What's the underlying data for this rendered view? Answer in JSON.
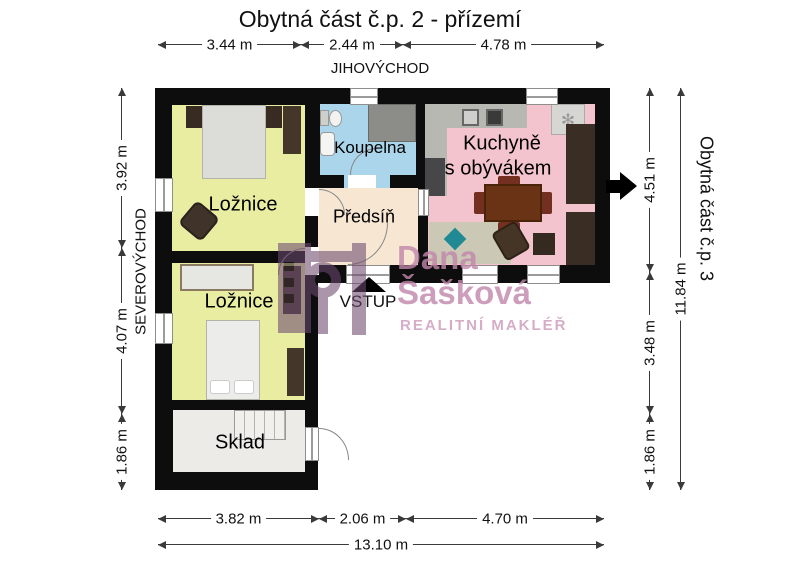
{
  "title": "Obytná část č.p. 2 - přízemí",
  "directions": {
    "southeast": "JIHOVÝCHOD",
    "northeast": "SEVEROVÝCHOD",
    "neighbor": "Obytná část č.p. 3"
  },
  "rooms": {
    "bedroom1": "Ložnice",
    "bedroom2": "Ložnice",
    "bathroom": "Koupelna",
    "hallway": "Předsíň",
    "kitchen_line1": "Kuchyně",
    "kitchen_line2": "s obývákem",
    "storage": "Sklad"
  },
  "entrance": {
    "label": "VSTUP"
  },
  "dimensions": {
    "top": [
      "3.44 m",
      "2.44 m",
      "4.78 m"
    ],
    "bottom": [
      "3.82 m",
      "2.06 m",
      "4.70 m"
    ],
    "bottom_total": "13.10 m",
    "left": [
      "3.92 m",
      "4.07 m",
      "1.86 m"
    ],
    "right": [
      "4.51 m",
      "3.48 m",
      "1.86 m"
    ],
    "right_total": "11.84 m"
  },
  "watermark": {
    "first_name": "Dana",
    "last_name": "Šašková",
    "tagline": "REALITNÍ MAKLÉŘ"
  },
  "colors": {
    "bedroom": "#e9eda2",
    "bathroom": "#aad5ea",
    "hallway": "#f6e6d2",
    "kitchen": "#f4c4ce",
    "storage": "#edebe7",
    "wall": "#0d0d0d",
    "watermark_text": "#c187ab",
    "watermark_logo": "#6d4a70"
  }
}
